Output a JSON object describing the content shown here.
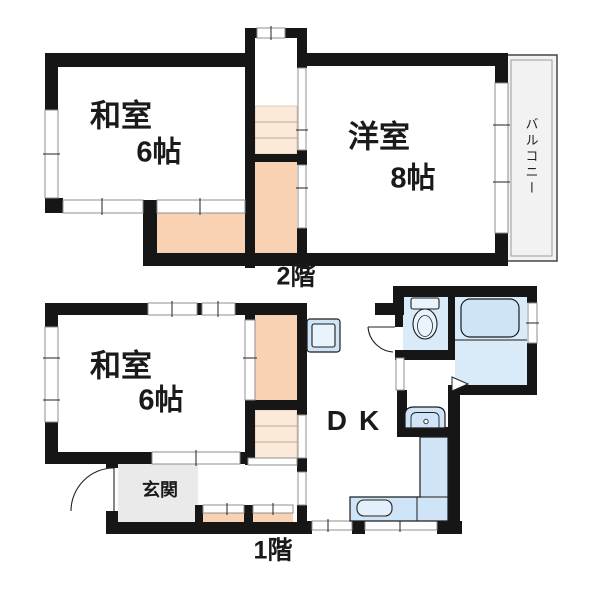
{
  "colors": {
    "wall": "#161616",
    "hall": "#f8d2b3",
    "steps": "#fcead9",
    "blueroom": "#d9eaf8",
    "bluefix": "#cfe4f6",
    "genkan": "#eaeaea",
    "balcony": "#f2f2f2"
  },
  "floor2": {
    "label": "2階",
    "washitsu": {
      "name": "和室",
      "size": "6帖"
    },
    "yoshitsu": {
      "name": "洋室",
      "size": "8帖"
    },
    "balcony": "バルコニー"
  },
  "floor1": {
    "label": "1階",
    "washitsu": {
      "name": "和室",
      "size": "6帖"
    },
    "dk": "DK",
    "genkan": "玄関"
  }
}
